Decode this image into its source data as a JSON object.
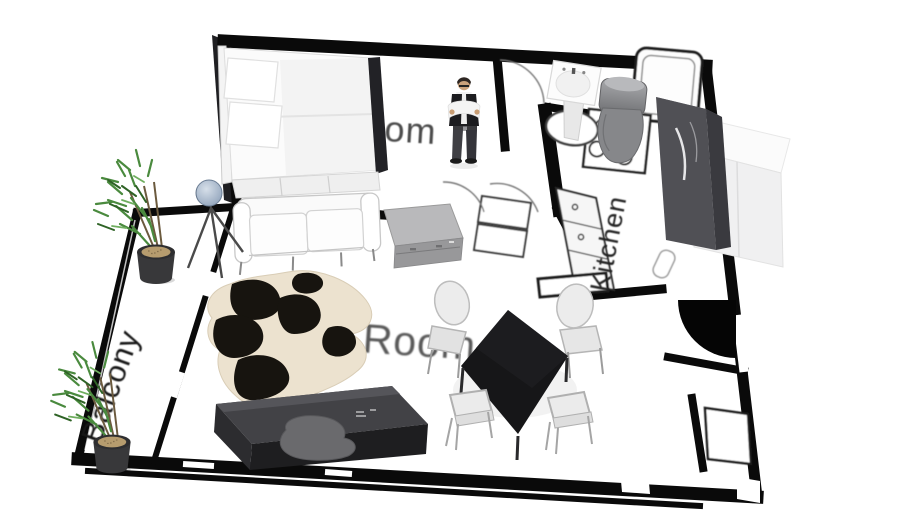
{
  "scene": {
    "title": "3D apartment floor plan model preview",
    "background": "#ffffff"
  },
  "labels": {
    "bedroom": "Room",
    "living_room": "Room",
    "kitchen": "Kitchen",
    "balcony": "Balcony"
  },
  "colors": {
    "wall": "#0a0a0a",
    "floor": "#ffffff",
    "label_text": "#3f3f3f",
    "table_black": "#17171a",
    "rug_cream": "#ece2cf",
    "rug_black": "#17140f",
    "chair_gray": "#ececec",
    "plant_green": "#4a8a3e",
    "plant_pot": "#38383a",
    "lamp_head": "#aebdd0",
    "toilet_gray": "#86878a",
    "piano_dark": "#2b2b2e",
    "sideboard_gray": "#b9b9bb",
    "fridge_white": "#f0f0f1",
    "kitchen_cabinet_dark": "#505055"
  },
  "objects": [
    "double-bed",
    "floor-lamp",
    "sofa",
    "sideboard",
    "cowhide-rug",
    "dining-table",
    "dining-chairs-x4",
    "piano-desk",
    "standing-person",
    "pedestal-sink",
    "toilet",
    "bathtub",
    "stove",
    "kitchen-counter",
    "refrigerator",
    "kitchen-cabinet",
    "potted-plant-x2",
    "entry-door-swing"
  ]
}
